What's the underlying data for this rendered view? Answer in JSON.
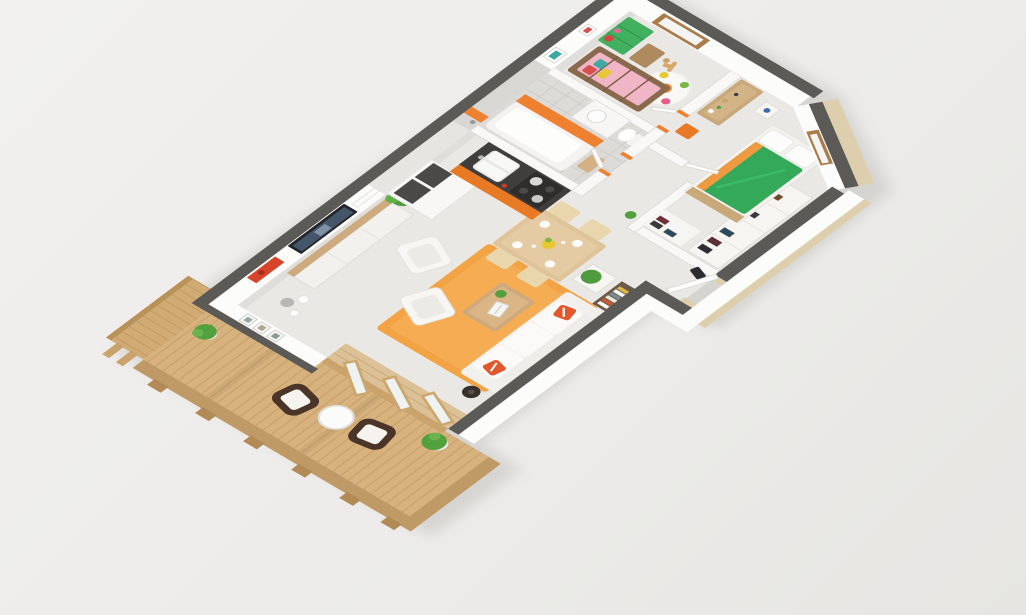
{
  "scene": {
    "title": "3D isometric cutaway floor plan of a two-bedroom apartment with balcony",
    "view": "high-angle isometric cutaway render, no text labels",
    "palette": {
      "background": "#edecea",
      "wall_cap": "#5b5a57",
      "wall_face": "#fcfcfb",
      "wall_cut_beige": "#ddcfae",
      "floor": "#eae8e4",
      "tile_gray": "#dcdbd7",
      "deck_wood": "#d7b27c",
      "fence_wood": "#d2ab74",
      "rug_orange": "#f2a344",
      "kitchen_orange": "#e87a26",
      "accent_orange": "#ef8030",
      "counter_dark": "#403e3c",
      "sofa_white": "#f5f4f1",
      "bed_green": "#35a95a",
      "dresser_green": "#41b05f",
      "crib_wood": "#8a6a4e",
      "crib_pink": "#f0b6c6",
      "table_wood": "#dfc499",
      "plant_green": "#53a03f",
      "wicker_dark": "#4a3528"
    },
    "rooms": [
      {
        "label": "living room",
        "furniture": [
          "tv console with flat-screen tv",
          "white three-seat sofa with orange pillows",
          "two white armchairs",
          "wood coffee table with laptop",
          "orange area rug",
          "bookshelf with books",
          "white cabinet with plant",
          "palm plant",
          "floor lamp",
          "decor vases",
          "red abstract wall art",
          "three picture frames",
          "folding glass doors to balcony"
        ]
      },
      {
        "label": "dining area",
        "furniture": [
          "light wood dining table",
          "four beige chairs",
          "white plates and cups",
          "yellow flower centerpiece"
        ]
      },
      {
        "label": "kitchen",
        "furniture": [
          "orange base cabinets with dark countertop",
          "double sink",
          "stove with pots",
          "tall white cabinets with dark tops"
        ]
      },
      {
        "label": "bathroom",
        "furniture": [
          "bathtub with orange side panel",
          "shower",
          "vanity sink",
          "toilet",
          "gray tiled walls with orange accent stripe",
          "wood bath mat"
        ]
      },
      {
        "label": "nursery",
        "furniture": [
          "wooden crib with pink bedding and colorful pillows",
          "green dresser with toys",
          "wood toy box",
          "rocking horse",
          "round white flower rug",
          "two wall posters",
          "wood framed window"
        ]
      },
      {
        "label": "hallway",
        "furniture": [
          "wood sideboard with bottles and decor",
          "orange stool",
          "orange door jambs"
        ]
      },
      {
        "label": "walk-in closet / entry",
        "furniture": [
          "white wardrobe units",
          "hanging clothes",
          "entry door ajar"
        ]
      },
      {
        "label": "bedroom",
        "furniture": [
          "double bed with green duvet and white pillows",
          "orange throw",
          "wood foot bench",
          "nightstand with blue lamp",
          "wood framed corner window"
        ]
      },
      {
        "label": "balcony",
        "furniture": [
          "wood plank decking",
          "two dark wicker armchairs with white cushions",
          "round white side table",
          "two potted plants",
          "wood privacy fence",
          "wood railing with posts"
        ]
      }
    ]
  }
}
